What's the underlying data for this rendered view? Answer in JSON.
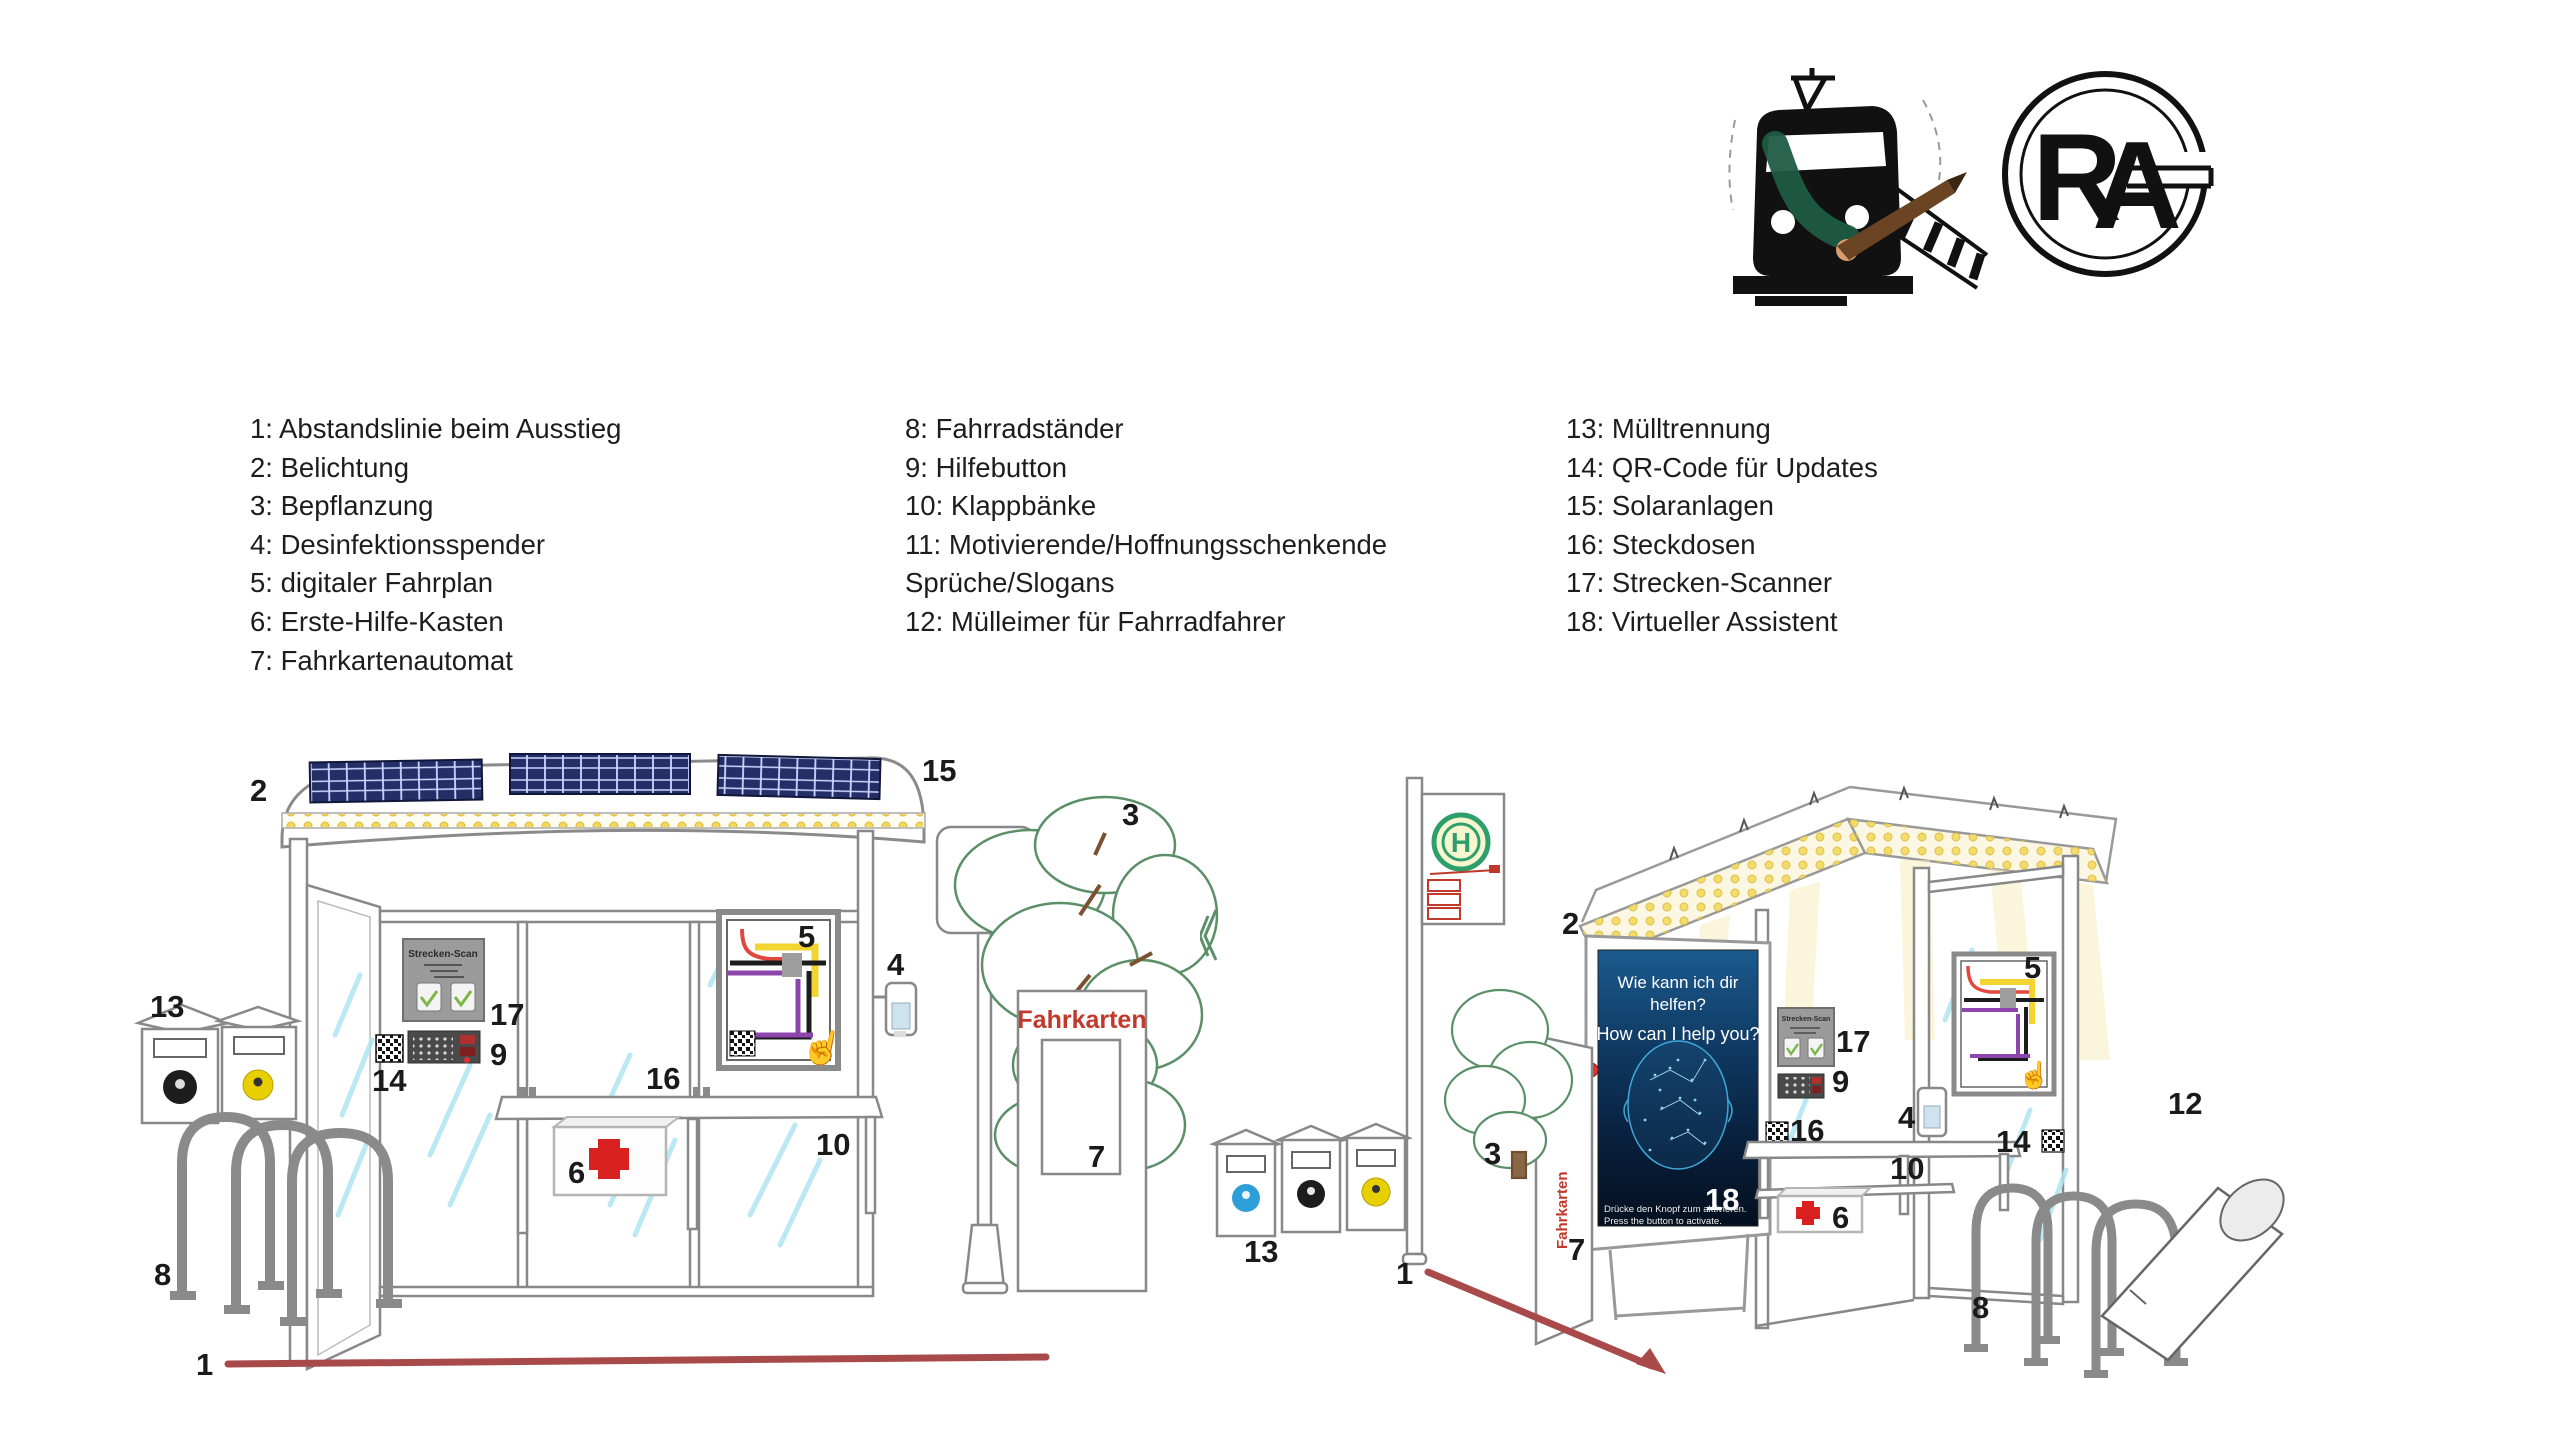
{
  "legend": {
    "col1": [
      "1: Abstandslinie beim Ausstieg",
      "2: Belichtung",
      "3: Bepflanzung",
      "4: Desinfektionsspender",
      "5: digitaler Fahrplan",
      "6: Erste-Hilfe-Kasten",
      "7: Fahrkartenautomat"
    ],
    "col2": [
      "8: Fahrradständer",
      "9: Hilfebutton",
      "10: Klappbänke",
      "11: Motivierende/Hoffnungsschenkende",
      "Sprüche/Slogans",
      "12: Mülleimer für Fahrradfahrer"
    ],
    "col3": [
      "13: Mülltrennung",
      "14: QR-Code für Updates",
      "15: Solaranlagen",
      "16: Steckdosen",
      "17: Strecken-Scanner",
      "18: Virtueller Assistent"
    ]
  },
  "callouts": {
    "left": {
      "1": "1",
      "2": "2",
      "3": "3",
      "4": "4",
      "5": "5",
      "6": "6",
      "7": "7",
      "8": "8",
      "9": "9",
      "10": "10",
      "13": "13",
      "14": "14",
      "15": "15",
      "16": "16",
      "17": "17"
    },
    "right": {
      "1": "1",
      "2": "2",
      "3": "3",
      "4": "4",
      "5": "5",
      "6": "6",
      "7": "7",
      "8": "8",
      "9": "9",
      "10": "10",
      "12": "12",
      "13": "13",
      "14": "14",
      "16": "16",
      "17": "17",
      "18": "18"
    }
  },
  "scene_text": {
    "strecken_scan": "Strecken-Scan",
    "fahrkarten": "Fahrkarten",
    "h_sign": "H",
    "poster_line1": "Wie kann ich dir",
    "poster_line2": "helfen?",
    "poster_line3": "How can I help you?",
    "poster_note_de": "Drücke den Knopf zum aktivieren.",
    "poster_note_en": "Press the button to activate."
  },
  "monogram": {
    "letter_r": "R",
    "letter_a": "A"
  },
  "icons": {
    "hand_pointer": "☝"
  },
  "colors": {
    "distance_line_red": "#a94a4a",
    "fahrkarten_red": "#c0392b",
    "first_aid_red": "#d92121",
    "solar_panel_navy": "#232f66",
    "roof_light_yellow": "#f2d95c",
    "glass_streak_blue": "#aee4f2",
    "tree_green": "#5b8f68",
    "h_sign_green": "#2e9e6b",
    "bin_label_blue": "#2d9fd8",
    "bin_label_black": "#1d1d1d",
    "bin_label_yellow": "#e7cf00",
    "metal_gray": "#8a8a8a"
  }
}
